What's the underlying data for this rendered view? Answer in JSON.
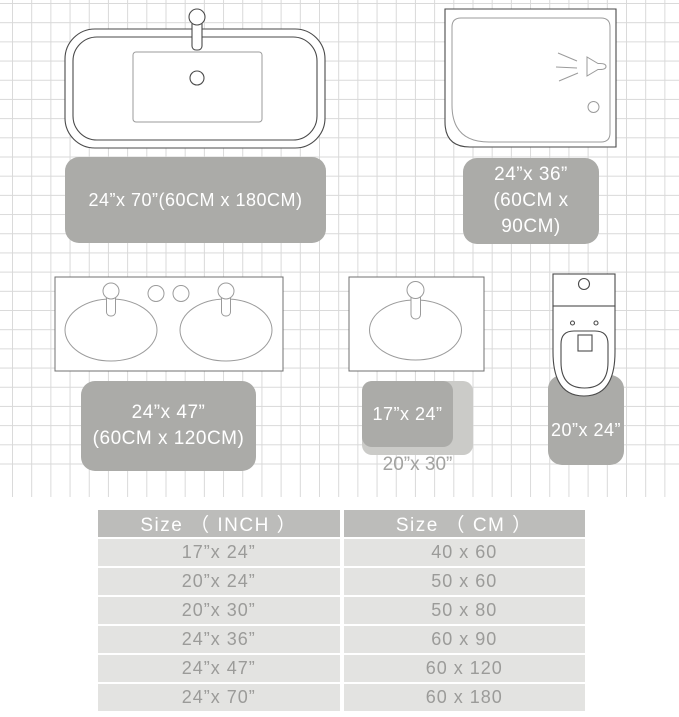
{
  "icons": {
    "bathtub": "bathtub-icon",
    "shower": "shower-icon",
    "double_vanity": "double-vanity-icon",
    "sink": "sink-icon",
    "toilet": "toilet-icon"
  },
  "rugs": {
    "bathtub": {
      "label": "24”x 70”(60CM x 180CM)"
    },
    "shower": {
      "line1": "24”x 36”",
      "line2": "(60CM x 90CM)"
    },
    "vanity": {
      "line1": "24”x 47”",
      "line2": "(60CM x 120CM)"
    },
    "sink_small": {
      "label": "17”x 24”"
    },
    "sink_large": {
      "label": "20”x 30”"
    },
    "toilet": {
      "label": "20”x 24”"
    }
  },
  "size_table": {
    "headers": [
      "Size （ INCH ）",
      "Size （ CM ）"
    ],
    "rows": [
      [
        "17”x 24”",
        "40 x 60"
      ],
      [
        "20”x 24”",
        "50 x 60"
      ],
      [
        "20”x 30”",
        "50 x 80"
      ],
      [
        "24”x 36”",
        "60 x 90"
      ],
      [
        "24”x 47”",
        "60 x 120"
      ],
      [
        "24”x 70”",
        "60 x 180"
      ]
    ]
  },
  "colors": {
    "rug": "#ABABA8",
    "rug_light": "#CBCBC8",
    "rug_text": "#FFFFFF",
    "rug_light_label_text": "#A2A2A0",
    "outline_dark": "#4A4A4A",
    "outline_light": "#9B9B9B",
    "grid_line": "#D9D9D9",
    "table_header_bg": "#BCBCBA",
    "table_header_text": "#FFFFFF",
    "table_row_bg": "#E3E3E1",
    "table_row_text": "#9B9B99"
  }
}
